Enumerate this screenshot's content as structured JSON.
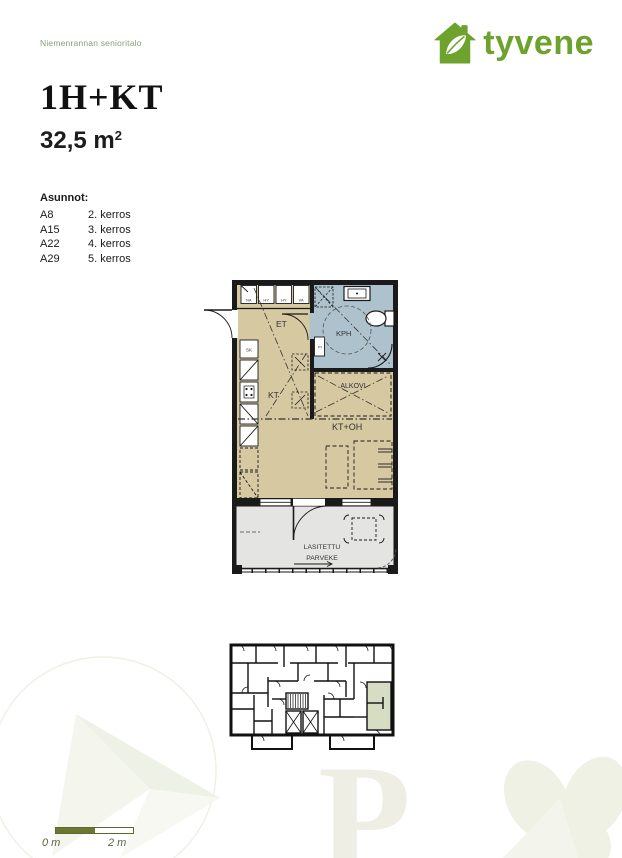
{
  "header": {
    "project_name": "Niemenrannan senioritalo",
    "brand": "tyvene"
  },
  "title": {
    "apartment_type": "1H+KT",
    "area_value": "32,5 m",
    "area_sup": "2"
  },
  "apartments": {
    "label": "Asunnot:",
    "items": [
      {
        "code": "A8",
        "floor": "2. kerros"
      },
      {
        "code": "A15",
        "floor": "3. kerros"
      },
      {
        "code": "A22",
        "floor": "4. kerros"
      },
      {
        "code": "A29",
        "floor": "5. kerros"
      }
    ]
  },
  "floor_plan": {
    "rooms": {
      "et": "ET",
      "kph": "KPH",
      "alkovi": "ALKOVI",
      "kt": "KT",
      "kt_oh": "KT+OH",
      "balcony_line1": "LASITETTU",
      "balcony_line2": "PARVEKE"
    },
    "fixtures": {
      "na": "NA",
      "hy1": "HY",
      "hy2": "HY",
      "va": "VA",
      "sk": "SK",
      "py": "PY"
    },
    "colors": {
      "room": "#d6c8a0",
      "bathroom": "#adc2cc",
      "balcony": "#e4e4e2",
      "wall": "#1a1a1a",
      "overview_highlight": "#d6ddc3"
    }
  },
  "scale_bar": {
    "start_label": "0 m",
    "end_label": "2 m",
    "color": "#6b7733"
  },
  "brand_colors": {
    "logo_green": "#6da22d",
    "muted_green": "#8b9e78"
  }
}
